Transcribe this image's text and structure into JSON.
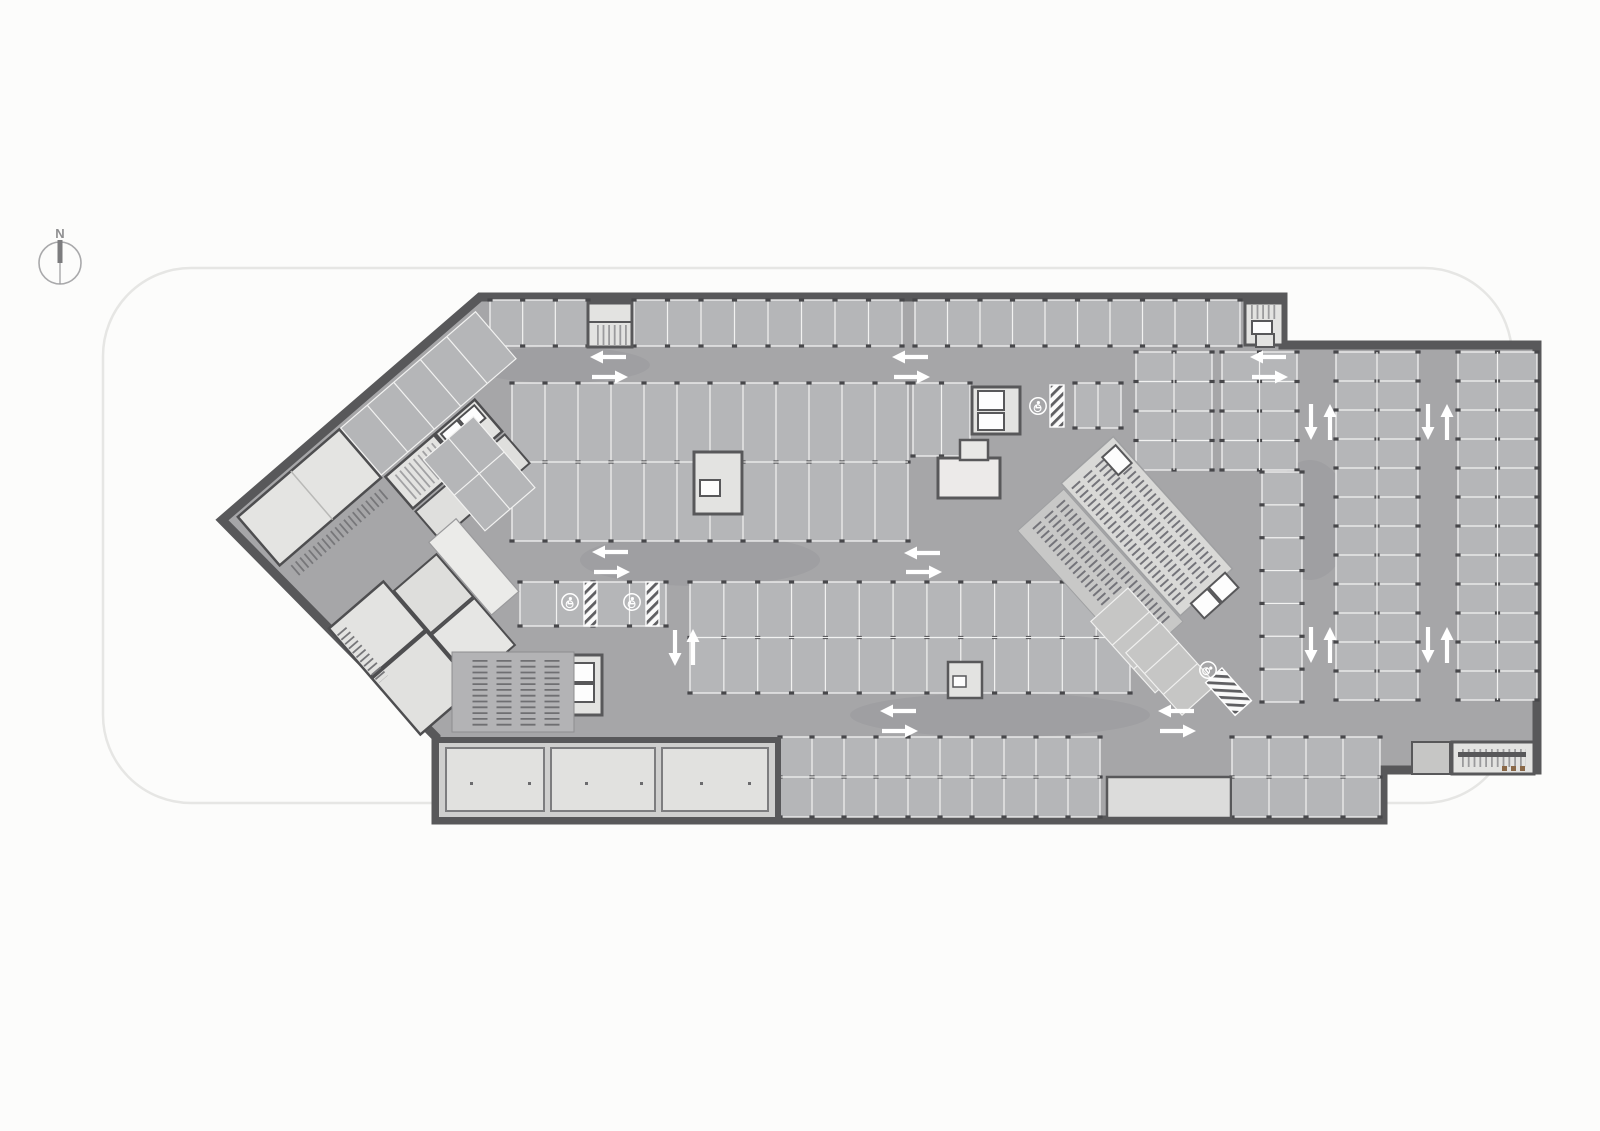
{
  "title": "Underground parking garage floor plan",
  "compass": {
    "label": "N"
  },
  "colors": {
    "wall": "#58585a",
    "aisle": "#a6a6a8",
    "stall": "#b5b6b8",
    "stall_line": "#f2f2f1",
    "room": "#e3e3e1",
    "elevator": "#fdfdfd",
    "tick": "#47474a",
    "arrow": "#ffffff",
    "hatch_dark": "#5f5f62",
    "site_line": "#e6e6e4",
    "rack": "#6f6f72",
    "door_marker": "#8a6847"
  },
  "plan": {
    "stall_blocks": [
      {
        "x": 490,
        "y": 300,
        "w": 98,
        "h": 46,
        "o": "v",
        "p": 33,
        "d": 0
      },
      {
        "x": 634,
        "y": 300,
        "w": 268,
        "h": 46,
        "o": "v",
        "p": 33.5,
        "d": 0
      },
      {
        "x": 915,
        "y": 300,
        "w": 325,
        "h": 46,
        "o": "v",
        "p": 33,
        "d": 0
      },
      {
        "x": 512,
        "y": 383,
        "w": 396,
        "h": 158,
        "o": "v",
        "p": 33,
        "d": 1
      },
      {
        "x": 913,
        "y": 383,
        "w": 57,
        "h": 73,
        "o": "v",
        "p": 28,
        "d": 0
      },
      {
        "x": 1075,
        "y": 383,
        "w": 46,
        "h": 45,
        "o": "v",
        "p": 23,
        "d": 0
      },
      {
        "x": 1136,
        "y": 352,
        "w": 76,
        "h": 118,
        "o": "h",
        "p": 30,
        "d": 1
      },
      {
        "x": 1222,
        "y": 352,
        "w": 75,
        "h": 118,
        "o": "h",
        "p": 30,
        "d": 1
      },
      {
        "x": 1336,
        "y": 352,
        "w": 82,
        "h": 348,
        "o": "h",
        "p": 29,
        "d": 1
      },
      {
        "x": 1458,
        "y": 352,
        "w": 79,
        "h": 348,
        "o": "h",
        "p": 29,
        "d": 1
      },
      {
        "x": 690,
        "y": 582,
        "w": 440,
        "h": 111,
        "o": "v",
        "p": 33,
        "d": 1
      },
      {
        "x": 520,
        "y": 582,
        "w": 146,
        "h": 44,
        "o": "v",
        "p": 38,
        "d": 0
      },
      {
        "x": 780,
        "y": 737,
        "w": 320,
        "h": 80,
        "o": "v",
        "p": 33,
        "d": 1
      },
      {
        "x": 1232,
        "y": 737,
        "w": 148,
        "h": 80,
        "o": "v",
        "p": 33,
        "d": 1
      },
      {
        "x": 1262,
        "y": 472,
        "w": 40,
        "h": 230,
        "o": "h",
        "p": 33,
        "d": 0
      }
    ],
    "arrows": [
      {
        "x": 608,
        "y": 357,
        "dir": "left"
      },
      {
        "x": 610,
        "y": 377,
        "dir": "right"
      },
      {
        "x": 910,
        "y": 357,
        "dir": "left"
      },
      {
        "x": 912,
        "y": 377,
        "dir": "right"
      },
      {
        "x": 1268,
        "y": 357,
        "dir": "left"
      },
      {
        "x": 1270,
        "y": 377,
        "dir": "right"
      },
      {
        "x": 1311,
        "y": 422,
        "dir": "down"
      },
      {
        "x": 1330,
        "y": 422,
        "dir": "up"
      },
      {
        "x": 1428,
        "y": 422,
        "dir": "down"
      },
      {
        "x": 1447,
        "y": 422,
        "dir": "up"
      },
      {
        "x": 610,
        "y": 552,
        "dir": "left"
      },
      {
        "x": 612,
        "y": 572,
        "dir": "right"
      },
      {
        "x": 922,
        "y": 553,
        "dir": "left"
      },
      {
        "x": 924,
        "y": 572,
        "dir": "right"
      },
      {
        "x": 675,
        "y": 648,
        "dir": "down"
      },
      {
        "x": 693,
        "y": 647,
        "dir": "up"
      },
      {
        "x": 1311,
        "y": 645,
        "dir": "down"
      },
      {
        "x": 1330,
        "y": 645,
        "dir": "up"
      },
      {
        "x": 1428,
        "y": 645,
        "dir": "down"
      },
      {
        "x": 1447,
        "y": 645,
        "dir": "up"
      },
      {
        "x": 898,
        "y": 711,
        "dir": "left"
      },
      {
        "x": 900,
        "y": 731,
        "dir": "right"
      },
      {
        "x": 1176,
        "y": 711,
        "dir": "left"
      },
      {
        "x": 1178,
        "y": 731,
        "dir": "right"
      }
    ],
    "accessible_stalls": [
      {
        "x": 570,
        "y": 602,
        "rot": 0,
        "hatch": {
          "x": 584,
          "y": 582,
          "w": 13,
          "h": 44,
          "rot": 0
        }
      },
      {
        "x": 632,
        "y": 602,
        "rot": 0,
        "hatch": {
          "x": 646,
          "y": 582,
          "w": 13,
          "h": 44,
          "rot": 0
        }
      },
      {
        "x": 1038,
        "y": 406,
        "rot": 0,
        "hatch": {
          "x": 1050,
          "y": 385,
          "w": 14,
          "h": 42,
          "rot": 0
        }
      },
      {
        "x": 1208,
        "y": 670,
        "rot": 48,
        "hatch": {
          "x": 1222,
          "y": 668,
          "w": 44,
          "h": 22,
          "rot": 48
        }
      }
    ],
    "bike_rack_columns": [
      {
        "x": 480,
        "y": 660,
        "length": 68
      },
      {
        "x": 504,
        "y": 660,
        "length": 68
      },
      {
        "x": 528,
        "y": 660,
        "length": 68
      },
      {
        "x": 552,
        "y": 660,
        "length": 68
      }
    ],
    "door_markers": [
      {
        "x": 1502,
        "y": 766
      },
      {
        "x": 1511,
        "y": 766
      },
      {
        "x": 1520,
        "y": 766
      }
    ],
    "interior_dots": [
      {
        "x": 470,
        "y": 782
      },
      {
        "x": 528,
        "y": 782
      },
      {
        "x": 585,
        "y": 782
      },
      {
        "x": 640,
        "y": 782
      },
      {
        "x": 700,
        "y": 782
      },
      {
        "x": 748,
        "y": 782
      }
    ]
  }
}
